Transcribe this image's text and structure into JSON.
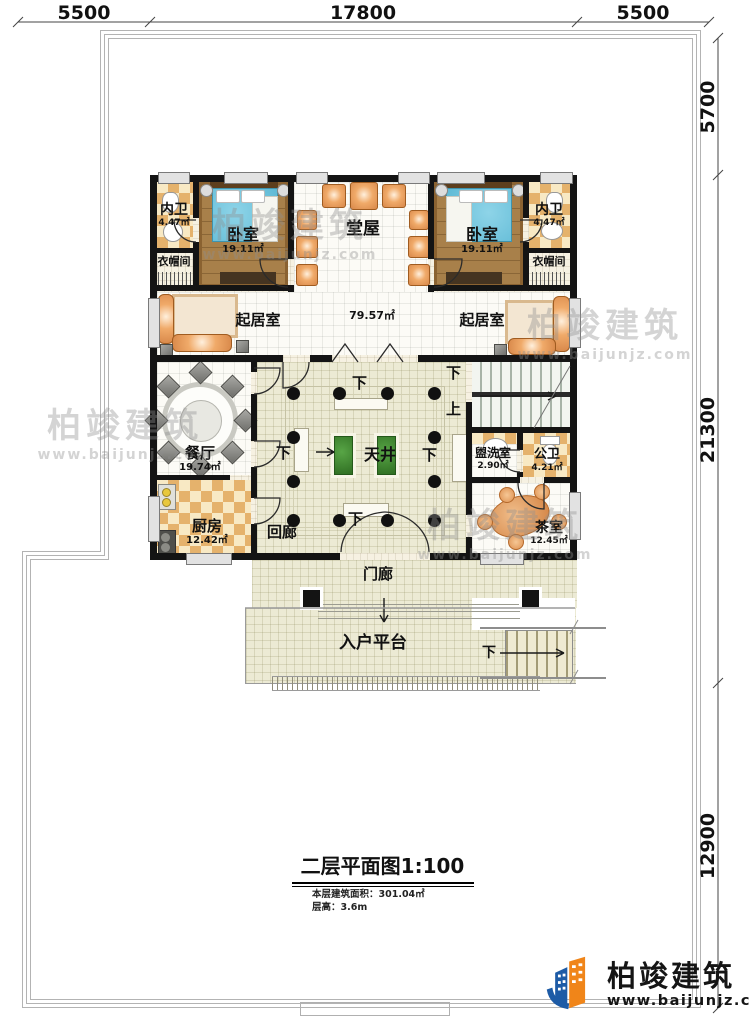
{
  "dimensions": {
    "top": [
      "5500",
      "17800",
      "5500"
    ],
    "right": [
      "5700",
      "21300",
      "12900"
    ]
  },
  "rooms": {
    "bath_left": {
      "name": "内卫",
      "area": "4.47㎡"
    },
    "bath_right": {
      "name": "内卫",
      "area": "4.47㎡"
    },
    "bedroom_left": {
      "name": "卧室",
      "area": "19.11㎡"
    },
    "bedroom_right": {
      "name": "卧室",
      "area": "19.11㎡"
    },
    "cloak_left": {
      "name": "衣帽间"
    },
    "cloak_right": {
      "name": "衣帽间"
    },
    "hall": {
      "name": "堂屋",
      "area": "79.57㎡"
    },
    "living_left": {
      "name": "起居室"
    },
    "living_right": {
      "name": "起居室"
    },
    "dining": {
      "name": "餐厅",
      "area": "19.74㎡"
    },
    "kitchen": {
      "name": "厨房",
      "area": "12.42㎡"
    },
    "courtyard": {
      "name": "天井"
    },
    "corridor": {
      "name": "回廊"
    },
    "washroom": {
      "name": "盥洗室",
      "area": "2.90㎡"
    },
    "toilet": {
      "name": "公卫",
      "area": "4.21㎡"
    },
    "tearoom": {
      "name": "茶室",
      "area": "12.45㎡"
    },
    "porch": {
      "name": "门廊"
    },
    "platform": {
      "name": "入户平台"
    }
  },
  "markers": {
    "down": "下",
    "up": "上"
  },
  "titleblock": {
    "title": "二层平面图1:100",
    "area_line": "本层建筑面积：301.04㎡",
    "height_line": "层高：3.6m"
  },
  "brand": {
    "name": "柏竣建筑",
    "url": "www.baijunjz.com"
  },
  "colors": {
    "wall": "#141414",
    "brand_blue": "#1d5ba6",
    "brand_orange": "#f08519"
  }
}
